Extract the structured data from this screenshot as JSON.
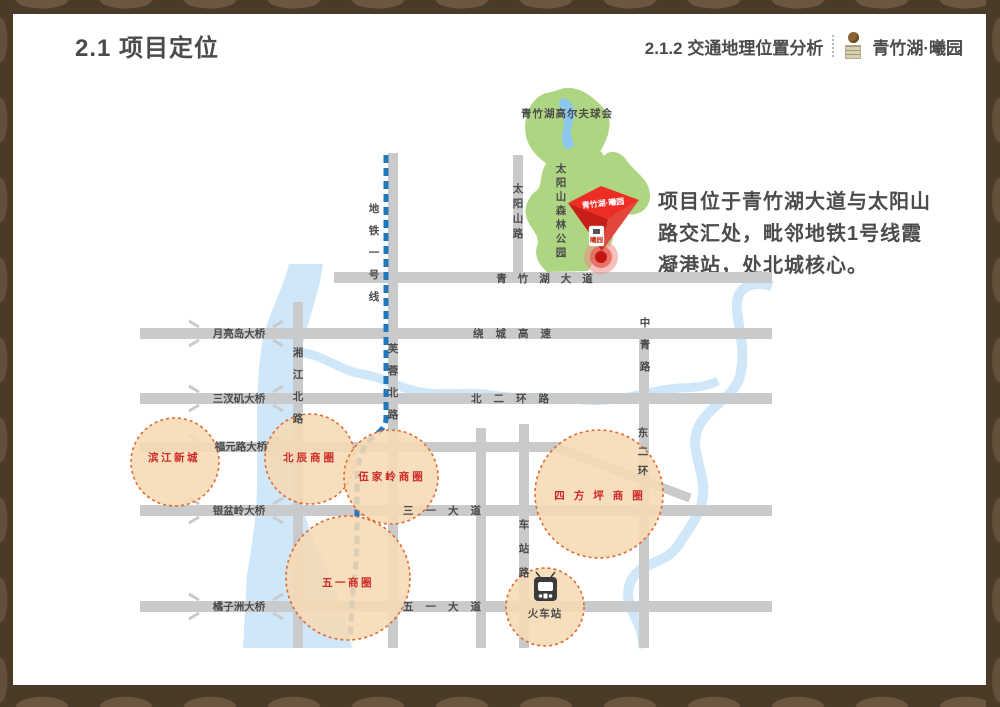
{
  "slide": {
    "header": {
      "title": "2.1 项目定位",
      "subtitle": "2.1.2 交通地理位置分析",
      "brand": "青竹湖·曦园"
    },
    "description": {
      "lines": [
        "项目位于青竹湖大道与太阳山",
        "路交汇处，毗邻地铁1号线霞",
        "凝港站，处北城核心。"
      ]
    }
  },
  "map": {
    "parks": {
      "golf": "青竹湖高尔夫球会",
      "forest": "太阳山森林公园"
    },
    "metro": {
      "label": "地铁一号线"
    },
    "roads": [
      {
        "label": "青竹湖大道"
      },
      {
        "label": "绕城高速"
      },
      {
        "label": "北二环路"
      },
      {
        "label": "三一大道"
      },
      {
        "label": "五一大道"
      },
      {
        "label": "湘江北路"
      },
      {
        "label": "芙蓉北路"
      },
      {
        "label": "太阳山路"
      },
      {
        "label": "车站路"
      },
      {
        "label": "中青路"
      },
      {
        "label": "东二环"
      }
    ],
    "bridges": [
      {
        "label": "月亮岛大桥"
      },
      {
        "label": "三汊矶大桥"
      },
      {
        "label": "福元路大桥"
      },
      {
        "label": "银盆岭大桥"
      },
      {
        "label": "橘子洲大桥"
      }
    ],
    "districts": [
      {
        "label": "滨江新城"
      },
      {
        "label": "北辰商圈"
      },
      {
        "label": "伍家岭商圈"
      },
      {
        "label": "四方坪商圈"
      },
      {
        "label": "五一商圈"
      }
    ],
    "station": {
      "label": "火车站"
    },
    "marker": {
      "label": "青竹湖·曦园",
      "badge": "曦园"
    }
  },
  "colors": {
    "frame": "#4a3a28",
    "road": "#c9cacb",
    "river": "#cfe7f8",
    "park": "#aed581",
    "lake": "#8cc8ec",
    "metro": "#1f78bb",
    "district_fill": "#f6d9b4",
    "district_stroke": "#e06a30",
    "district_text": "#ce2b28",
    "marker_red": "#ee2e24",
    "label": "#4a4a4a"
  }
}
